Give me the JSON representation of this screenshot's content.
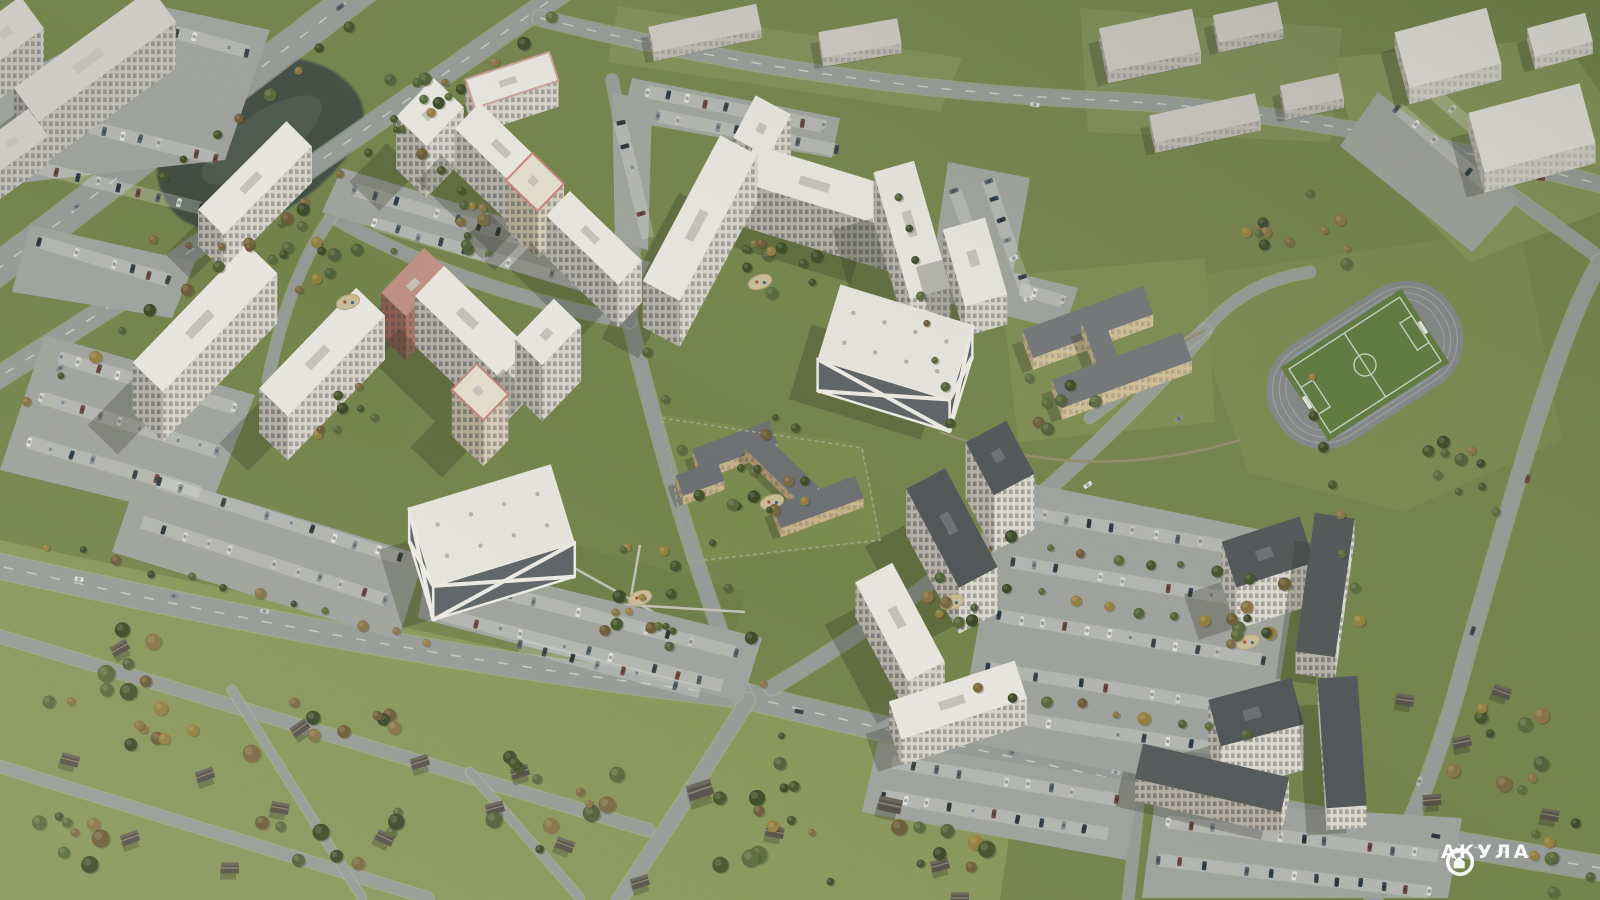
{
  "watermark": {
    "brand": "АКУЛА",
    "logo_icon": "drop-house-circle-logo"
  },
  "scene": {
    "type": "aerial-architectural-render",
    "subject": "residential district with white high-rise towers, two parking garages with X-pattern facades, kindergarten, school, football stadium, pond, highway, forests and suburban houses"
  },
  "palette": {
    "grass": "#76854d",
    "field_light": "#8a985c",
    "forest": "#45522c",
    "water": "#434f44",
    "road": "#989d9a",
    "parking_lot": "#a2a5a0",
    "building_white": "#eceae3",
    "building_facade_lit": "#dbd7ce",
    "building_facade_shade": "#b6b2a9",
    "brick_accent": "#b07a68",
    "pink_roof_accent": "#c9857f",
    "dark_roof": "#53575a",
    "pitch_green": "#5f7d40",
    "watermark_white": "#ffffff"
  }
}
